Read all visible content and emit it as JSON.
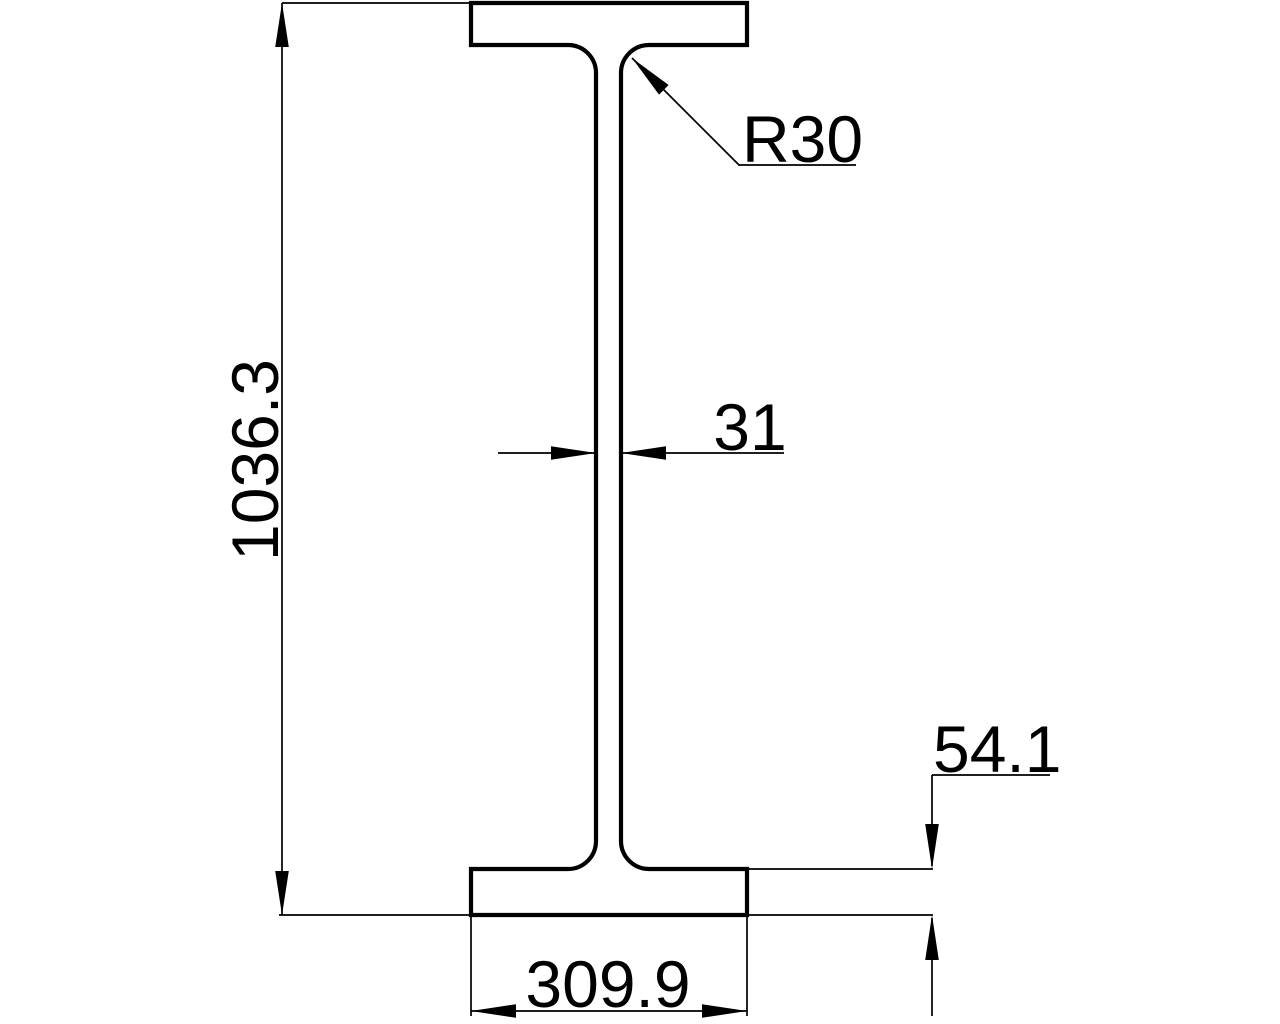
{
  "page": {
    "background_color": "#ffffff",
    "line_color": "#000000"
  },
  "drawing": {
    "shape": "i-beam-cross-section",
    "labels": {
      "overall_height": "1036.3",
      "fillet_radius": "R30",
      "web_thickness": "31",
      "flange_thickness": "54.1",
      "flange_width": "309.9"
    }
  }
}
